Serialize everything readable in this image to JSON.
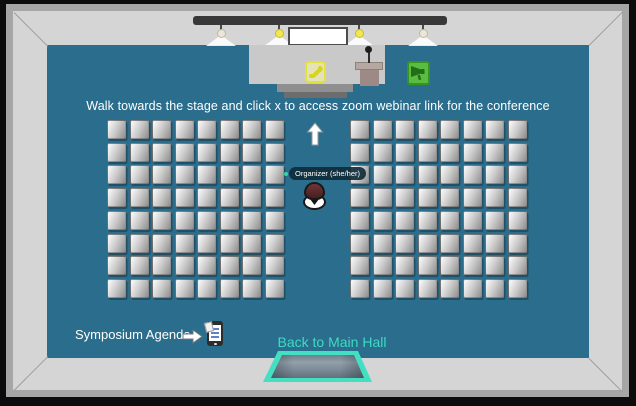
{
  "hud": {
    "instruction": "Walk towards the stage and click x to access zoom webinar link for the conference",
    "agenda_label": "Symposium Agenda",
    "back_to_main_hall_label": "Back to Main Hall"
  },
  "player": {
    "name_tag": "Organizer (she/her)",
    "status_dot_color": "#35d6a0"
  },
  "seating": {
    "blocks": [
      "left",
      "right"
    ],
    "rows": 8,
    "cols": 8,
    "total_seats": 128
  },
  "icons": {
    "phone": "phone-receiver",
    "megaphone": "megaphone",
    "agenda_document": "document-on-device",
    "up_arrow": "↑",
    "right_arrow": "➡",
    "stage_lights": 4,
    "podium": "podium-with-mic"
  },
  "colors": {
    "floor": "#2a6d8c",
    "wall": "#d5d5d5",
    "wall_edge": "#a6a6a6",
    "frame": "#0c0c0c",
    "stage": "#c9c9c9",
    "accent_teal": "#3edbc2",
    "portal_border": "#43dfc3",
    "phone_yellow": "#e3e23c",
    "megaphone_green": "#58bd40",
    "avatar_hat": "#5d2b2e"
  }
}
